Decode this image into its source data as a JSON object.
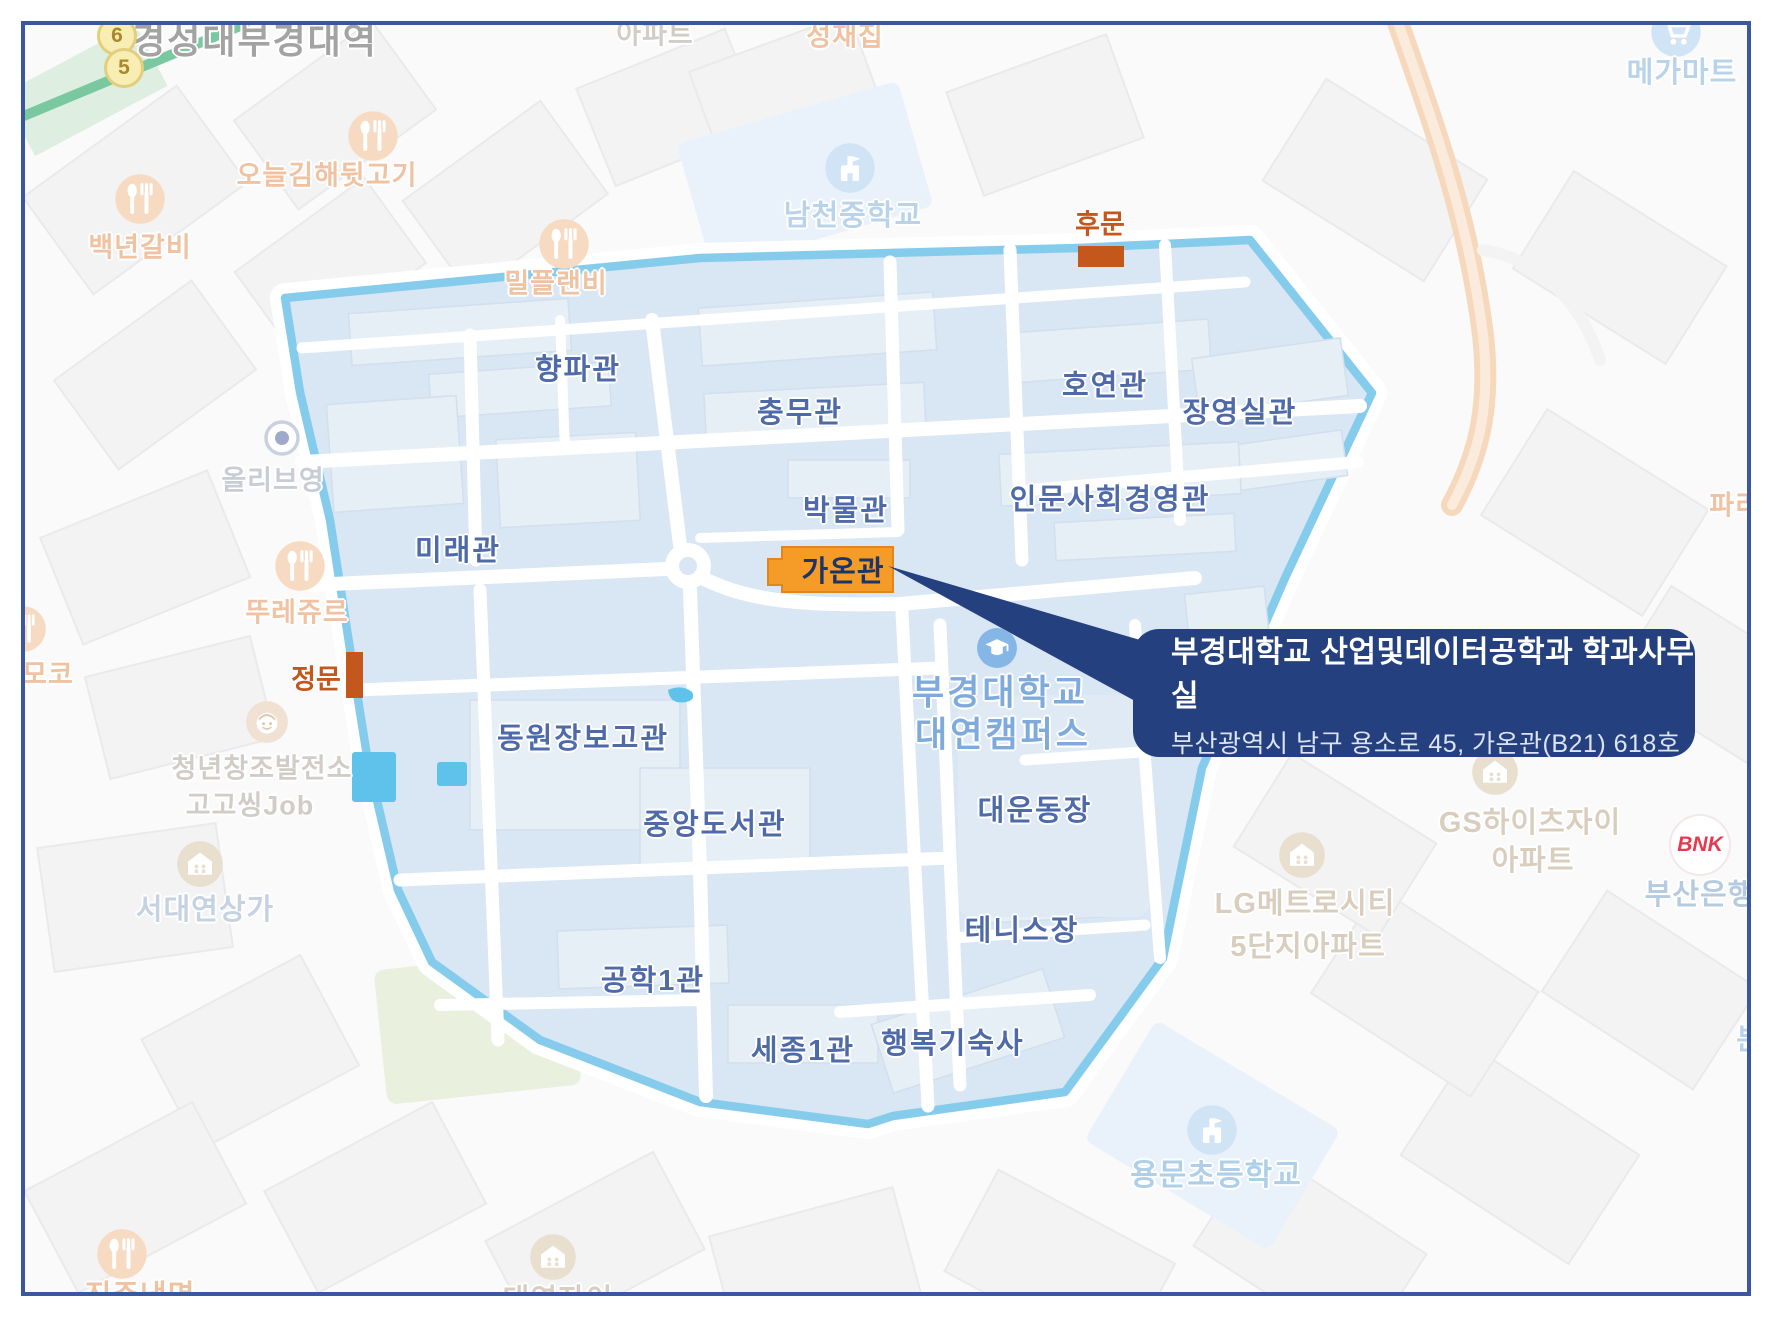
{
  "station": {
    "name": "경성대부경대역",
    "exit_badges": [
      "6",
      "5"
    ]
  },
  "gates": {
    "back": "후문",
    "main": "정문"
  },
  "campus": {
    "name_line1": "부경대학교",
    "name_line2": "대연캠퍼스",
    "buildings": {
      "hyangpa": "향파관",
      "chungmu": "충무관",
      "hoyeon": "호연관",
      "jangyeongsil": "장영실관",
      "museum": "박물관",
      "inmunsahoe": "인문사회경영관",
      "mirae": "미래관",
      "gaon": "가온관",
      "dongwonjangbogo": "동원장보고관",
      "jungang_library": "중앙도서관",
      "daeundongjang": "대운동장",
      "tennis": "테니스장",
      "gonghak1": "공학1관",
      "sejong1": "세종1관",
      "haengbok_dorm": "행복기숙사"
    }
  },
  "callout": {
    "title": "부경대학교 산업및데이터공학과 학과사무실",
    "address": "부산광역시 남구 용소로 45, 가온관(B21) 618호"
  },
  "pois": {
    "restaurant_oneul": "오늘김해뒷고기",
    "restaurant_baeknyeon": "백년갈비",
    "restaurant_milplan": "밀플랜비",
    "restaurant_tous": "뚜레쥬르",
    "restaurant_moko": "모코",
    "restaurant_seongjae": "성재집",
    "restaurant_jinju": "진주냉면",
    "school_namcheon": "남천중학교",
    "school_yongmun": "용문초등학교",
    "mart_mega": "메가마트",
    "shop_olive": "올리브영",
    "shop_seodaeyeon": "서대연상가",
    "bank_bnk": "BNK",
    "bank_busan": "부산은행",
    "apt_top": "아파트",
    "apt_gs_line1": "GS하이츠자이",
    "apt_gs_line2": "아파트",
    "apt_lg_line1": "LG메트로시티",
    "apt_lg_line2": "5단지아파트",
    "apt_daeyeon": "대연자이",
    "youth_line1": "청년창조발전소",
    "youth_line2": "고고씽Job",
    "paris": "파리바",
    "bun": "분"
  },
  "colors": {
    "frame_navy": "#3A57A0",
    "callout_navy": "#24407E",
    "campus_fill": "#D9E6F3",
    "campus_border": "#85CCEC",
    "building_fill": "#E6EEF6",
    "building_label": "#4E6AA9",
    "campus_name": "#7FABDC",
    "gate_orange": "#C4571B",
    "gaon_orange": "#F59C28",
    "subway_green": "#79C8A0",
    "highway_orange": "#F6D9BD",
    "pond_blue": "#5FC2EA"
  }
}
